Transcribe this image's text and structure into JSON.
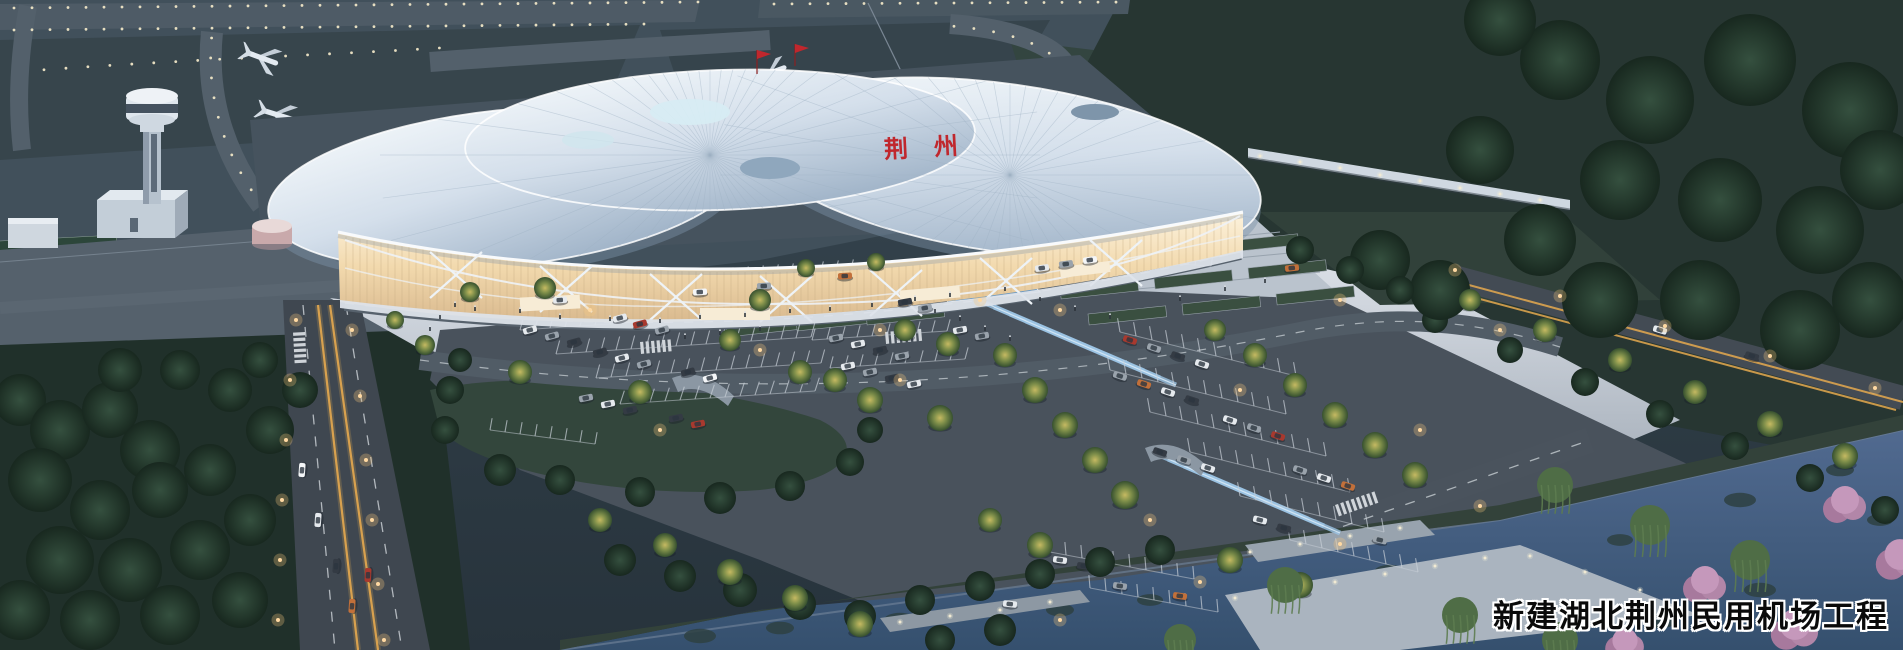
{
  "caption": {
    "text": "新建湖北荆州民用机场工程"
  },
  "terminal": {
    "roof_sign": "荆州"
  },
  "colors": {
    "sign_red": "#c0272d",
    "roof_white": "#eef3f8",
    "glass_glow": "#f2d9ad",
    "airfield": "#41505b",
    "forest_dark": "#1f2e28",
    "asphalt": "#4a545e",
    "plaza_light": "#d3dae1",
    "water_blue": "#46608a",
    "warm_light": "#ffd9a2",
    "tree_lit": "#8f9a4d",
    "cherry_pink": "#bb8bae"
  },
  "scene": {
    "car_colors": [
      "#e6eaee",
      "#9aa3ac",
      "#343b44",
      "#a8392e",
      "#c2703a",
      "#6b7480",
      "#f4f6f8"
    ],
    "cars": [
      [
        530,
        330,
        -15,
        0
      ],
      [
        552,
        336,
        -15,
        1
      ],
      [
        574,
        342,
        -15,
        2
      ],
      [
        620,
        318,
        -15,
        0
      ],
      [
        640,
        324,
        -15,
        3
      ],
      [
        662,
        330,
        -15,
        1
      ],
      [
        600,
        352,
        -15,
        2
      ],
      [
        622,
        358,
        -15,
        0
      ],
      [
        644,
        364,
        -15,
        1
      ],
      [
        688,
        372,
        -15,
        2
      ],
      [
        710,
        378,
        -15,
        6
      ],
      [
        586,
        398,
        -12,
        1
      ],
      [
        608,
        404,
        -12,
        0
      ],
      [
        630,
        410,
        -12,
        2
      ],
      [
        676,
        418,
        -12,
        2
      ],
      [
        698,
        424,
        -12,
        3
      ],
      [
        836,
        338,
        -12,
        1
      ],
      [
        858,
        344,
        -12,
        0
      ],
      [
        880,
        350,
        -12,
        2
      ],
      [
        902,
        356,
        -12,
        1
      ],
      [
        848,
        366,
        -12,
        0
      ],
      [
        870,
        372,
        -12,
        1
      ],
      [
        892,
        378,
        -12,
        2
      ],
      [
        914,
        384,
        -12,
        0
      ],
      [
        960,
        330,
        -10,
        0
      ],
      [
        982,
        336,
        -10,
        1
      ],
      [
        1042,
        268,
        -8,
        0
      ],
      [
        1066,
        264,
        -8,
        1
      ],
      [
        1090,
        260,
        -8,
        6
      ],
      [
        1130,
        340,
        18,
        3
      ],
      [
        1154,
        348,
        18,
        1
      ],
      [
        1178,
        356,
        18,
        2
      ],
      [
        1202,
        364,
        18,
        0
      ],
      [
        1120,
        376,
        18,
        1
      ],
      [
        1144,
        384,
        18,
        4
      ],
      [
        1168,
        392,
        18,
        0
      ],
      [
        1192,
        400,
        18,
        2
      ],
      [
        1230,
        420,
        18,
        0
      ],
      [
        1254,
        428,
        18,
        1
      ],
      [
        1278,
        436,
        18,
        3
      ],
      [
        1160,
        452,
        18,
        2
      ],
      [
        1184,
        460,
        18,
        1
      ],
      [
        1208,
        468,
        18,
        0
      ],
      [
        1300,
        470,
        18,
        1
      ],
      [
        1324,
        478,
        18,
        0
      ],
      [
        1348,
        486,
        18,
        4
      ],
      [
        1260,
        520,
        14,
        0
      ],
      [
        1284,
        528,
        14,
        2
      ],
      [
        1380,
        540,
        14,
        1
      ],
      [
        1060,
        560,
        8,
        0
      ],
      [
        1084,
        566,
        8,
        2
      ],
      [
        1120,
        586,
        8,
        1
      ],
      [
        1180,
        596,
        8,
        4
      ],
      [
        1010,
        604,
        6,
        0
      ],
      [
        318,
        520,
        -86,
        0
      ],
      [
        336,
        566,
        -86,
        2
      ],
      [
        352,
        606,
        -86,
        4
      ],
      [
        302,
        470,
        -86,
        6
      ],
      [
        368,
        575,
        -87,
        3
      ],
      [
        560,
        300,
        -4,
        0
      ],
      [
        700,
        292,
        -3,
        6
      ],
      [
        764,
        286,
        -3,
        1
      ],
      [
        845,
        276,
        -3,
        4
      ],
      [
        1292,
        268,
        -6,
        4
      ],
      [
        1660,
        330,
        17,
        0
      ],
      [
        1752,
        356,
        17,
        2
      ],
      [
        905,
        302,
        -10,
        2
      ],
      [
        925,
        308,
        -10,
        1
      ]
    ],
    "trees_lit": [
      [
        470,
        292,
        10
      ],
      [
        545,
        288,
        11
      ],
      [
        760,
        300,
        11
      ],
      [
        800,
        372,
        12
      ],
      [
        835,
        380,
        12
      ],
      [
        520,
        372,
        12
      ],
      [
        730,
        340,
        11
      ],
      [
        905,
        330,
        11
      ],
      [
        948,
        344,
        12
      ],
      [
        640,
        392,
        12
      ],
      [
        870,
        400,
        13
      ],
      [
        940,
        418,
        13
      ],
      [
        1005,
        355,
        12
      ],
      [
        1035,
        390,
        13
      ],
      [
        1065,
        425,
        13
      ],
      [
        1095,
        460,
        13
      ],
      [
        1125,
        495,
        14
      ],
      [
        1215,
        330,
        11
      ],
      [
        1255,
        355,
        12
      ],
      [
        1295,
        385,
        12
      ],
      [
        1335,
        415,
        13
      ],
      [
        1375,
        445,
        13
      ],
      [
        1415,
        475,
        13
      ],
      [
        1230,
        560,
        13
      ],
      [
        1300,
        585,
        13
      ],
      [
        990,
        520,
        12
      ],
      [
        1040,
        545,
        13
      ],
      [
        1470,
        300,
        11
      ],
      [
        1545,
        330,
        12
      ],
      [
        1620,
        360,
        12
      ],
      [
        1695,
        392,
        12
      ],
      [
        1770,
        424,
        13
      ],
      [
        1845,
        456,
        13
      ],
      [
        600,
        520,
        12
      ],
      [
        665,
        545,
        12
      ],
      [
        730,
        572,
        13
      ],
      [
        795,
        598,
        13
      ],
      [
        860,
        624,
        13
      ],
      [
        425,
        345,
        10
      ],
      [
        395,
        320,
        9
      ],
      [
        876,
        262,
        9
      ],
      [
        806,
        268,
        9
      ]
    ],
    "trees_dark": [
      [
        20,
        400,
        26
      ],
      [
        60,
        430,
        30
      ],
      [
        110,
        410,
        28
      ],
      [
        150,
        450,
        30
      ],
      [
        40,
        480,
        32
      ],
      [
        100,
        510,
        30
      ],
      [
        160,
        490,
        28
      ],
      [
        210,
        470,
        26
      ],
      [
        60,
        560,
        34
      ],
      [
        130,
        570,
        32
      ],
      [
        200,
        550,
        30
      ],
      [
        250,
        520,
        26
      ],
      [
        20,
        610,
        30
      ],
      [
        90,
        620,
        30
      ],
      [
        170,
        615,
        30
      ],
      [
        240,
        600,
        28
      ],
      [
        270,
        430,
        24
      ],
      [
        230,
        390,
        22
      ],
      [
        180,
        370,
        20
      ],
      [
        120,
        370,
        22
      ],
      [
        300,
        390,
        18
      ],
      [
        260,
        360,
        18
      ],
      [
        450,
        390,
        14
      ],
      [
        500,
        470,
        16
      ],
      [
        560,
        480,
        15
      ],
      [
        640,
        492,
        15
      ],
      [
        720,
        498,
        16
      ],
      [
        790,
        486,
        15
      ],
      [
        850,
        462,
        14
      ],
      [
        870,
        430,
        13
      ],
      [
        445,
        430,
        14
      ],
      [
        460,
        360,
        12
      ],
      [
        620,
        560,
        16
      ],
      [
        680,
        576,
        16
      ],
      [
        740,
        590,
        17
      ],
      [
        800,
        604,
        16
      ],
      [
        860,
        616,
        16
      ],
      [
        920,
        600,
        15
      ],
      [
        980,
        586,
        15
      ],
      [
        1040,
        574,
        15
      ],
      [
        1100,
        562,
        15
      ],
      [
        1160,
        550,
        15
      ],
      [
        1000,
        630,
        16
      ],
      [
        940,
        640,
        15
      ],
      [
        1435,
        320,
        13
      ],
      [
        1510,
        350,
        13
      ],
      [
        1585,
        382,
        14
      ],
      [
        1660,
        414,
        14
      ],
      [
        1735,
        446,
        14
      ],
      [
        1810,
        478,
        14
      ],
      [
        1885,
        510,
        14
      ],
      [
        1560,
        60,
        40
      ],
      [
        1650,
        100,
        44
      ],
      [
        1750,
        60,
        46
      ],
      [
        1850,
        110,
        48
      ],
      [
        1620,
        180,
        40
      ],
      [
        1720,
        200,
        42
      ],
      [
        1820,
        230,
        44
      ],
      [
        1880,
        170,
        40
      ],
      [
        1540,
        240,
        36
      ],
      [
        1600,
        300,
        38
      ],
      [
        1700,
        300,
        40
      ],
      [
        1800,
        330,
        40
      ],
      [
        1870,
        300,
        38
      ],
      [
        1480,
        150,
        34
      ],
      [
        1500,
        20,
        36
      ],
      [
        1380,
        260,
        30
      ],
      [
        1440,
        290,
        30
      ],
      [
        1300,
        250,
        14
      ],
      [
        1350,
        270,
        14
      ],
      [
        1400,
        290,
        14
      ]
    ],
    "willows": [
      [
        1555,
        485,
        18
      ],
      [
        1650,
        525,
        20
      ],
      [
        1750,
        560,
        20
      ],
      [
        1285,
        585,
        18
      ],
      [
        1460,
        615,
        18
      ],
      [
        1560,
        640,
        18
      ],
      [
        1180,
        640,
        16
      ]
    ],
    "cherries": [
      [
        1845,
        505,
        20
      ],
      [
        1900,
        560,
        22
      ],
      [
        1705,
        585,
        20
      ],
      [
        1795,
        630,
        22
      ],
      [
        1625,
        645,
        18
      ]
    ],
    "lamps": [
      [
        296,
        320
      ],
      [
        352,
        330
      ],
      [
        290,
        380
      ],
      [
        360,
        396
      ],
      [
        286,
        440
      ],
      [
        366,
        460
      ],
      [
        282,
        500
      ],
      [
        372,
        520
      ],
      [
        280,
        560
      ],
      [
        378,
        584
      ],
      [
        278,
        620
      ],
      [
        384,
        640
      ],
      [
        1455,
        270
      ],
      [
        1560,
        296
      ],
      [
        1665,
        326
      ],
      [
        1770,
        356
      ],
      [
        1875,
        388
      ],
      [
        760,
        350
      ],
      [
        980,
        300
      ],
      [
        900,
        380
      ],
      [
        1240,
        390
      ],
      [
        1420,
        430
      ],
      [
        660,
        430
      ],
      [
        1150,
        520
      ],
      [
        590,
        310
      ],
      [
        880,
        330
      ],
      [
        1060,
        310
      ],
      [
        1340,
        300
      ],
      [
        1500,
        330
      ],
      [
        1060,
        620
      ],
      [
        1200,
        582
      ],
      [
        1340,
        544
      ],
      [
        1480,
        506
      ]
    ],
    "people": [
      [
        455,
        306
      ],
      [
        475,
        310
      ],
      [
        520,
        312
      ],
      [
        560,
        318
      ],
      [
        610,
        320
      ],
      [
        660,
        322
      ],
      [
        700,
        318
      ],
      [
        745,
        316
      ],
      [
        790,
        312
      ],
      [
        830,
        310
      ],
      [
        872,
        306
      ],
      [
        915,
        300
      ],
      [
        950,
        296
      ],
      [
        1005,
        290
      ],
      [
        1040,
        300
      ],
      [
        1075,
        310
      ],
      [
        1110,
        318
      ],
      [
        960,
        320
      ],
      [
        985,
        330
      ],
      [
        1010,
        340
      ],
      [
        935,
        312
      ],
      [
        760,
        330
      ],
      [
        720,
        334
      ],
      [
        685,
        338
      ],
      [
        1180,
        300
      ],
      [
        1225,
        290
      ],
      [
        1265,
        282
      ],
      [
        440,
        318
      ],
      [
        430,
        330
      ]
    ],
    "stall_rows": [
      [
        640,
        286,
        16,
        15,
        -1,
        13,
        75
      ],
      [
        490,
        306,
        12,
        15,
        -1,
        13,
        75
      ],
      [
        520,
        330,
        18,
        15,
        -1,
        13,
        75
      ],
      [
        556,
        354,
        18,
        15,
        -1,
        14,
        75
      ],
      [
        596,
        378,
        16,
        15,
        -1,
        14,
        75
      ],
      [
        620,
        404,
        14,
        15,
        -1,
        14,
        72
      ],
      [
        812,
        340,
        10,
        15,
        -1,
        12,
        75
      ],
      [
        830,
        368,
        10,
        15,
        -1,
        12,
        75
      ],
      [
        1035,
        255,
        12,
        16,
        1,
        12,
        80
      ],
      [
        1120,
        332,
        12,
        16,
        4,
        14,
        100
      ],
      [
        1110,
        370,
        12,
        16,
        4,
        14,
        100
      ],
      [
        1150,
        412,
        12,
        16,
        4,
        14,
        100
      ],
      [
        1190,
        452,
        11,
        16,
        4,
        14,
        100
      ],
      [
        1240,
        496,
        10,
        16,
        4,
        14,
        100
      ],
      [
        1290,
        540,
        9,
        16,
        4,
        14,
        100
      ],
      [
        1050,
        552,
        10,
        16,
        3,
        13,
        95
      ],
      [
        1090,
        588,
        9,
        16,
        3,
        13,
        95
      ],
      [
        490,
        430,
        8,
        15,
        2,
        12,
        80
      ]
    ],
    "lawn_strips": [
      [
        1032,
        262
      ],
      [
        1126,
        252
      ],
      [
        1220,
        242
      ],
      [
        1060,
        288
      ],
      [
        1154,
        278
      ],
      [
        1248,
        268
      ],
      [
        1088,
        314
      ],
      [
        1182,
        304
      ],
      [
        1276,
        294
      ],
      [
        720,
        302
      ],
      [
        790,
        296
      ],
      [
        860,
        290
      ],
      [
        726,
        326
      ],
      [
        796,
        320
      ],
      [
        866,
        314
      ]
    ],
    "crosswalks": [
      [
        640,
        342,
        -5,
        6
      ],
      [
        885,
        332,
        -5,
        7
      ],
      [
        1335,
        505,
        -19,
        8
      ],
      [
        1398,
        543,
        -19,
        7
      ],
      [
        305,
        332,
        87,
        6
      ]
    ],
    "queues": [
      {
        "start": [
          978,
          300
        ],
        "step": [
          16,
          7
        ],
        "len": [
          150,
          64
        ],
        "n": 4
      },
      {
        "start": [
          1152,
          452
        ],
        "step": [
          16,
          7
        ],
        "len": [
          140,
          60
        ],
        "n": 4
      }
    ],
    "lily_pads": [
      [
        700,
        636,
        16
      ],
      [
        780,
        628,
        14
      ],
      [
        900,
        620,
        16
      ],
      [
        1060,
        610,
        14
      ],
      [
        1150,
        600,
        13
      ],
      [
        1390,
        572,
        16
      ],
      [
        1520,
        556,
        14
      ],
      [
        1620,
        540,
        13
      ],
      [
        1740,
        500,
        16
      ],
      [
        1840,
        470,
        14
      ],
      [
        1880,
        520,
        13
      ],
      [
        1660,
        620,
        18
      ],
      [
        1760,
        590,
        16
      ],
      [
        1560,
        610,
        14
      ]
    ],
    "deck_lights": [
      [
        1235,
        598
      ],
      [
        1285,
        590
      ],
      [
        1335,
        582
      ],
      [
        1385,
        574
      ],
      [
        1435,
        566
      ],
      [
        1485,
        558
      ],
      [
        1530,
        556
      ],
      [
        1585,
        572
      ],
      [
        1640,
        590
      ],
      [
        1695,
        608
      ],
      [
        1250,
        552
      ],
      [
        1300,
        544
      ],
      [
        1350,
        536
      ],
      [
        1400,
        528
      ],
      [
        900,
        622
      ],
      [
        950,
        616
      ],
      [
        1000,
        610
      ],
      [
        1050,
        602
      ],
      [
        1260,
        156
      ],
      [
        1300,
        162
      ],
      [
        1340,
        168
      ],
      [
        1380,
        175
      ],
      [
        1420,
        181
      ],
      [
        1460,
        188
      ],
      [
        1500,
        194
      ],
      [
        1540,
        200
      ]
    ]
  }
}
